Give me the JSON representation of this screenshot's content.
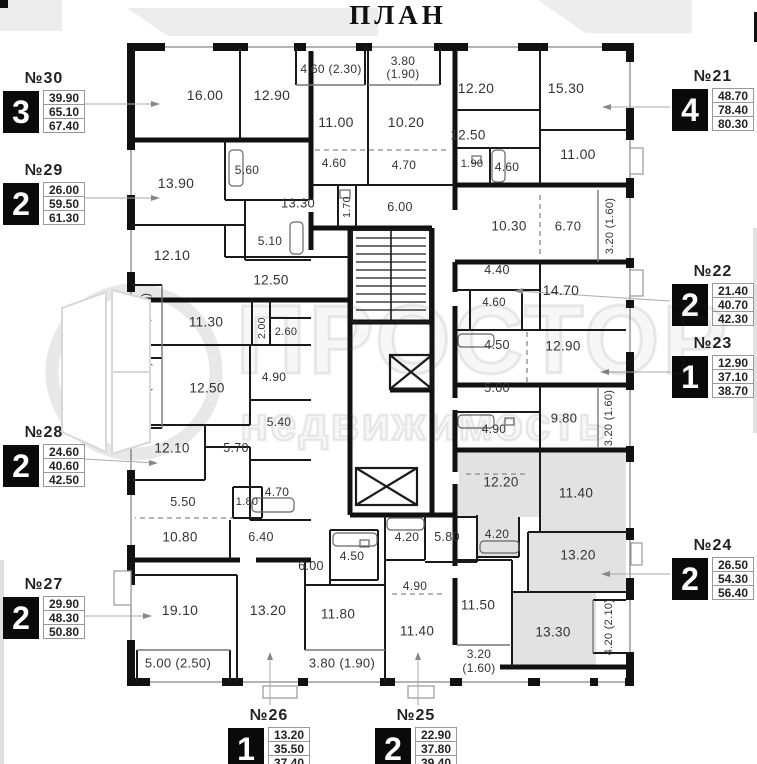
{
  "title": "ПЛАН",
  "watermark": {
    "brand": "ПРОСТОР",
    "tagline": "НЕДВИЖИМОСТЬ"
  },
  "accent_colors": {
    "wall": "#111111",
    "gray_room": "#e2e2e2",
    "label": "#333333"
  },
  "apartments": [
    {
      "number": "№30",
      "rooms": "3",
      "areas": [
        "39.90",
        "65.10",
        "67.40"
      ],
      "x": 3,
      "y": 70
    },
    {
      "number": "№29",
      "rooms": "2",
      "areas": [
        "26.00",
        "59.50",
        "61.30"
      ],
      "x": 3,
      "y": 162
    },
    {
      "number": "№28",
      "rooms": "2",
      "areas": [
        "24.60",
        "40.60",
        "42.50"
      ],
      "x": 3,
      "y": 424
    },
    {
      "number": "№27",
      "rooms": "2",
      "areas": [
        "29.90",
        "48.30",
        "50.80"
      ],
      "x": 3,
      "y": 576
    },
    {
      "number": "№21",
      "rooms": "4",
      "areas": [
        "48.70",
        "78.40",
        "80.30"
      ],
      "x": 672,
      "y": 68
    },
    {
      "number": "№22",
      "rooms": "2",
      "areas": [
        "21.40",
        "40.70",
        "42.30"
      ],
      "x": 672,
      "y": 263
    },
    {
      "number": "№23",
      "rooms": "1",
      "areas": [
        "12.90",
        "37.10",
        "38.70"
      ],
      "x": 672,
      "y": 335
    },
    {
      "number": "№24",
      "rooms": "2",
      "areas": [
        "26.50",
        "54.30",
        "56.40"
      ],
      "x": 672,
      "y": 537
    },
    {
      "number": "№26",
      "rooms": "1",
      "areas": [
        "13.20",
        "35.50",
        "37.40"
      ],
      "x": 228,
      "y": 707
    },
    {
      "number": "№25",
      "rooms": "2",
      "areas": [
        "22.90",
        "37.80",
        "39.40"
      ],
      "x": 375,
      "y": 707
    }
  ],
  "room_labels": [
    {
      "t": "16.00",
      "x": 205,
      "y": 95,
      "s": 14
    },
    {
      "t": "12.90",
      "x": 272,
      "y": 95,
      "s": 14
    },
    {
      "t": "4.60 (2.30)",
      "x": 331,
      "y": 69,
      "s": 12
    },
    {
      "t": "3.80",
      "x": 403,
      "y": 61,
      "s": 12
    },
    {
      "t": "(1.90)",
      "x": 403,
      "y": 74,
      "s": 12
    },
    {
      "t": "11.00",
      "x": 336,
      "y": 122,
      "s": 14
    },
    {
      "t": "10.20",
      "x": 406,
      "y": 122,
      "s": 14
    },
    {
      "t": "12.20",
      "x": 476,
      "y": 88,
      "s": 14
    },
    {
      "t": "15.30",
      "x": 566,
      "y": 88,
      "s": 14
    },
    {
      "t": "13.90",
      "x": 176,
      "y": 183,
      "s": 14
    },
    {
      "t": "5.60",
      "x": 247,
      "y": 170,
      "s": 12
    },
    {
      "t": "13.30",
      "x": 298,
      "y": 203,
      "s": 13
    },
    {
      "t": "5.10",
      "x": 270,
      "y": 241,
      "s": 12
    },
    {
      "t": "12.10",
      "x": 172,
      "y": 255,
      "s": 14
    },
    {
      "t": "4.60",
      "x": 334,
      "y": 163,
      "s": 12
    },
    {
      "t": "4.70",
      "x": 404,
      "y": 165,
      "s": 12
    },
    {
      "t": "1.70",
      "x": 347,
      "y": 207,
      "s": 10.5,
      "v": 1
    },
    {
      "t": "6.00",
      "x": 400,
      "y": 207,
      "s": 12.5
    },
    {
      "t": "12.50",
      "x": 468,
      "y": 135,
      "s": 13.5
    },
    {
      "t": "1.90",
      "x": 472,
      "y": 164,
      "s": 11
    },
    {
      "t": "4.60",
      "x": 507,
      "y": 167,
      "s": 12
    },
    {
      "t": "11.00",
      "x": 578,
      "y": 154,
      "s": 14
    },
    {
      "t": "10.30",
      "x": 509,
      "y": 226,
      "s": 13.5
    },
    {
      "t": "6.70",
      "x": 568,
      "y": 226,
      "s": 13
    },
    {
      "t": "3.20 (1.60)",
      "x": 610,
      "y": 226,
      "s": 11,
      "v": 1
    },
    {
      "t": "4.40",
      "x": 497,
      "y": 270,
      "s": 12.5
    },
    {
      "t": "14.70",
      "x": 561,
      "y": 290,
      "s": 14
    },
    {
      "t": "4.60",
      "x": 494,
      "y": 303,
      "s": 11.5
    },
    {
      "t": "12.50",
      "x": 271,
      "y": 280,
      "s": 13.5
    },
    {
      "t": "11.30",
      "x": 206,
      "y": 322,
      "s": 13.5
    },
    {
      "t": "3.60 (1.80)",
      "x": 146,
      "y": 321,
      "s": 11,
      "v": 1
    },
    {
      "t": "2.00",
      "x": 262,
      "y": 328,
      "s": 10.5,
      "v": 1
    },
    {
      "t": "2.60",
      "x": 286,
      "y": 332,
      "s": 11
    },
    {
      "t": "4.90",
      "x": 274,
      "y": 377,
      "s": 12
    },
    {
      "t": "12.50",
      "x": 207,
      "y": 388,
      "s": 13.5
    },
    {
      "t": "3.80 (1.90)",
      "x": 147,
      "y": 390,
      "s": 11,
      "v": 1
    },
    {
      "t": "5.40",
      "x": 279,
      "y": 422,
      "s": 12
    },
    {
      "t": "4.50",
      "x": 497,
      "y": 345,
      "s": 12.5
    },
    {
      "t": "12.90",
      "x": 563,
      "y": 346,
      "s": 13.5
    },
    {
      "t": "5.00",
      "x": 497,
      "y": 388,
      "s": 12.5
    },
    {
      "t": "3.20 (1.60)",
      "x": 609,
      "y": 418,
      "s": 11,
      "v": 1
    },
    {
      "t": "9.80",
      "x": 564,
      "y": 418,
      "s": 13
    },
    {
      "t": "4.90",
      "x": 494,
      "y": 429,
      "s": 12
    },
    {
      "t": "12.10",
      "x": 172,
      "y": 448,
      "s": 13.5
    },
    {
      "t": "5.70",
      "x": 236,
      "y": 448,
      "s": 12.5
    },
    {
      "t": "4.70",
      "x": 277,
      "y": 492,
      "s": 12
    },
    {
      "t": "5.50",
      "x": 183,
      "y": 502,
      "s": 12.5
    },
    {
      "t": "1.80",
      "x": 247,
      "y": 502,
      "s": 11
    },
    {
      "t": "10.80",
      "x": 180,
      "y": 537,
      "s": 13.5
    },
    {
      "t": "6.40",
      "x": 261,
      "y": 537,
      "s": 12.5
    },
    {
      "t": "12.20",
      "x": 501,
      "y": 482,
      "s": 13.5
    },
    {
      "t": "11.40",
      "x": 576,
      "y": 493,
      "s": 13.5
    },
    {
      "t": "6.00",
      "x": 311,
      "y": 566,
      "s": 12.5
    },
    {
      "t": "4.50",
      "x": 352,
      "y": 556,
      "s": 12
    },
    {
      "t": "4.20",
      "x": 407,
      "y": 537,
      "s": 12
    },
    {
      "t": "5.80",
      "x": 447,
      "y": 537,
      "s": 12.5
    },
    {
      "t": "4.20",
      "x": 497,
      "y": 534,
      "s": 12
    },
    {
      "t": "4.90",
      "x": 415,
      "y": 586,
      "s": 12
    },
    {
      "t": "19.10",
      "x": 180,
      "y": 610,
      "s": 14
    },
    {
      "t": "13.20",
      "x": 268,
      "y": 610,
      "s": 14
    },
    {
      "t": "11.80",
      "x": 338,
      "y": 614,
      "s": 13.5
    },
    {
      "t": "11.40",
      "x": 417,
      "y": 631,
      "s": 13.5
    },
    {
      "t": "11.50",
      "x": 478,
      "y": 605,
      "s": 13.5
    },
    {
      "t": "13.20",
      "x": 578,
      "y": 555,
      "s": 13.5
    },
    {
      "t": "13.30",
      "x": 553,
      "y": 632,
      "s": 13.5
    },
    {
      "t": "3.20",
      "x": 479,
      "y": 654,
      "s": 12
    },
    {
      "t": "(1.60)",
      "x": 479,
      "y": 668,
      "s": 12
    },
    {
      "t": "5.00 (2.50)",
      "x": 178,
      "y": 663,
      "s": 13
    },
    {
      "t": "3.80 (1.90)",
      "x": 342,
      "y": 663,
      "s": 13
    },
    {
      "t": "4.20 (2.10)",
      "x": 609,
      "y": 627,
      "s": 11,
      "v": 1
    }
  ]
}
